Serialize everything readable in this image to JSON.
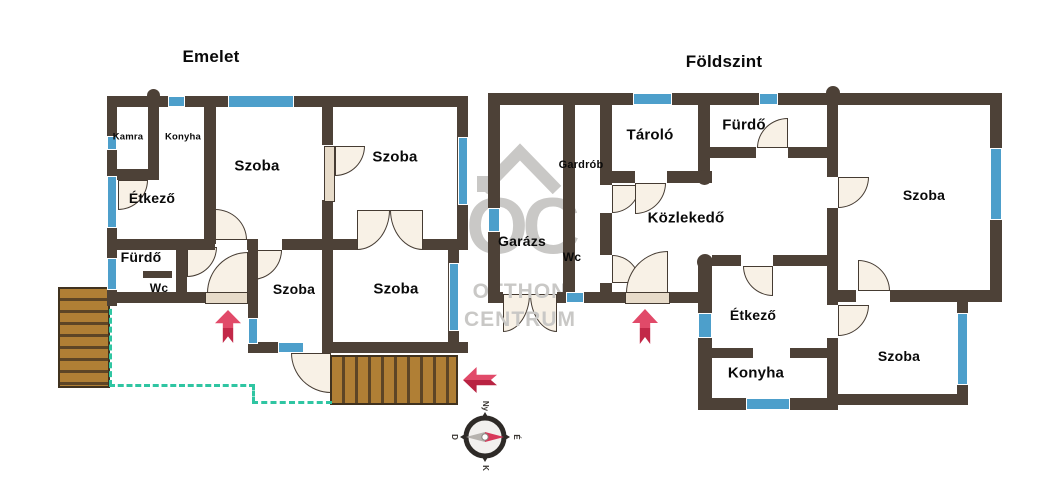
{
  "floors": {
    "emelet": {
      "title": "Emelet",
      "rooms": {
        "kamra": "Kamra",
        "konyha": "Konyha",
        "szoba1": "Szoba",
        "szoba2": "Szoba",
        "etkezo": "Étkező",
        "furdo": "Fürdő",
        "wc": "Wc",
        "szoba3": "Szoba",
        "szoba4": "Szoba"
      }
    },
    "foldszint": {
      "title": "Földszint",
      "rooms": {
        "garazs": "Garázs",
        "gardrob": "Gardrób",
        "tarolo": "Tároló",
        "furdo": "Fürdő",
        "wc": "Wc",
        "kozlekedo": "Közlekedő",
        "etkezo": "Étkező",
        "konyha": "Konyha",
        "szoba_nagy": "Szoba",
        "szoba_kis": "Szoba"
      }
    }
  },
  "compass": {
    "top": "Ny",
    "right": "É",
    "bottom": "K",
    "left": "D"
  },
  "watermark": {
    "monogram": "OC",
    "line1": "OTTHON",
    "line2": "CENTRUM"
  },
  "colors": {
    "wall": "#4d4137",
    "window": "#4d9fcb",
    "door": "#f8f1e6",
    "deck": "#b07f35",
    "terrace_line": "#2fc5a2",
    "arrow": "#d8395b",
    "watermark": "#c9c8c6"
  }
}
